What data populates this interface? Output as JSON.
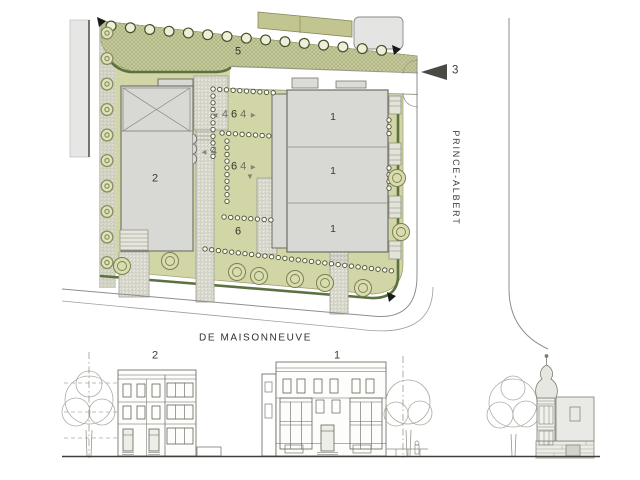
{
  "plan": {
    "zone_labels": {
      "zone5": "5",
      "zone6": "6"
    },
    "building_labels": {
      "building2": "2",
      "building1_units": [
        "1",
        "1",
        "1"
      ]
    },
    "dimensions": {
      "row_top": {
        "left_arrow": "◄",
        "left_value": "4",
        "center_value": "6",
        "right_value": "4",
        "right_arrow": "►"
      },
      "left_mark": {
        "arrow": "◄",
        "value": "4"
      },
      "row_mid": {
        "left_value": "6",
        "right_value": "4",
        "arrow": "►"
      },
      "down_arrow": "▼"
    },
    "entrance_marker": {
      "label": "3"
    },
    "streets": {
      "east": "PRINCE-ALBERT",
      "south": "DE MAISONNEUVE"
    }
  },
  "elevation": {
    "building2_label": "2",
    "building1_label": "1"
  },
  "colors": {
    "site_green": "#d2d6a6",
    "hatch_green": "#c9cd9c",
    "hedge_green": "#5c7140",
    "building_gray": "#d8d8d4",
    "olive_building": "#c3c590",
    "line_gray": "#8e8e8e"
  }
}
